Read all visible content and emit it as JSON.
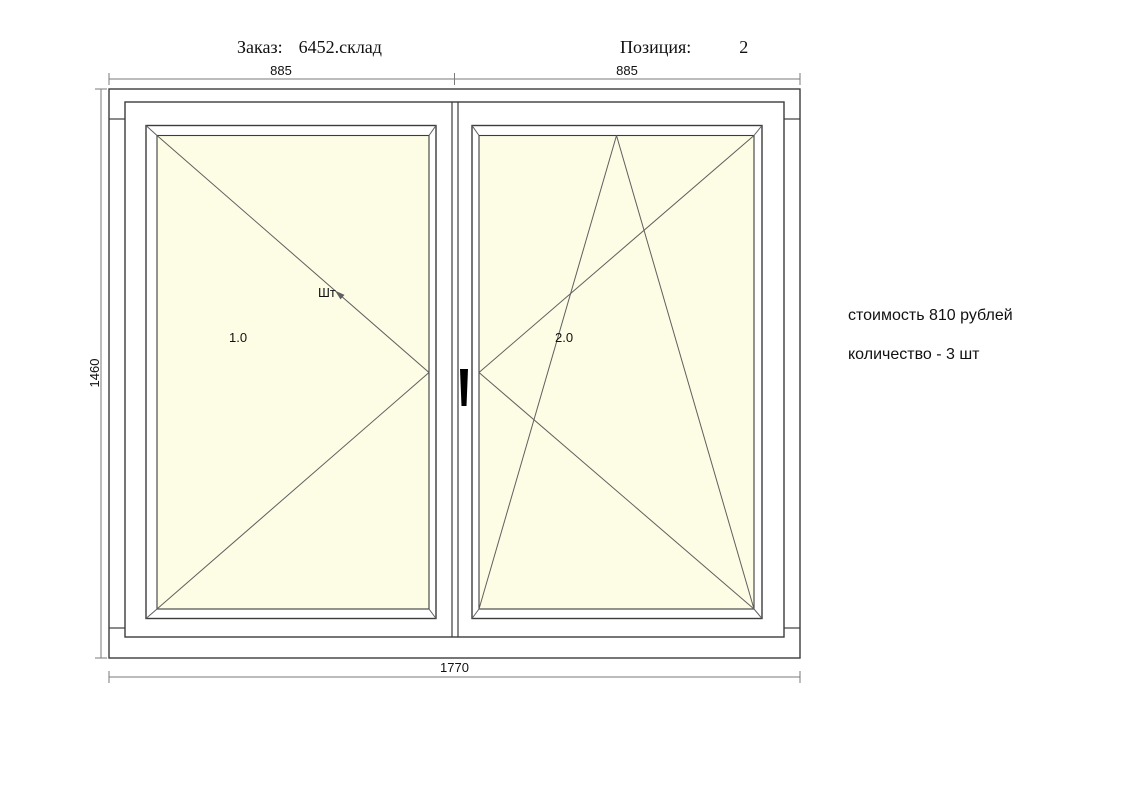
{
  "header": {
    "order_label": "Заказ:",
    "order_value": "6452.склад",
    "position_label": "Позиция:",
    "position_value": "2"
  },
  "dimensions": {
    "width_left": "885",
    "width_right": "885",
    "height": "1460",
    "total_width": "1770"
  },
  "drawing": {
    "sash_left_number": "1.0",
    "sash_left_tag": "Шт",
    "sash_right_number": "2.0"
  },
  "info": {
    "cost_line": "стоимость 810 рублей",
    "quantity_line": "количество - 3 шт"
  },
  "colors": {
    "background": "#ffffff",
    "glass": "#FDFCE5",
    "frame_line": "#3c3c3c",
    "open_line": "#5f5f5f",
    "dim_line": "#7a7a7a",
    "text": "#111111",
    "handle": "#000000"
  }
}
